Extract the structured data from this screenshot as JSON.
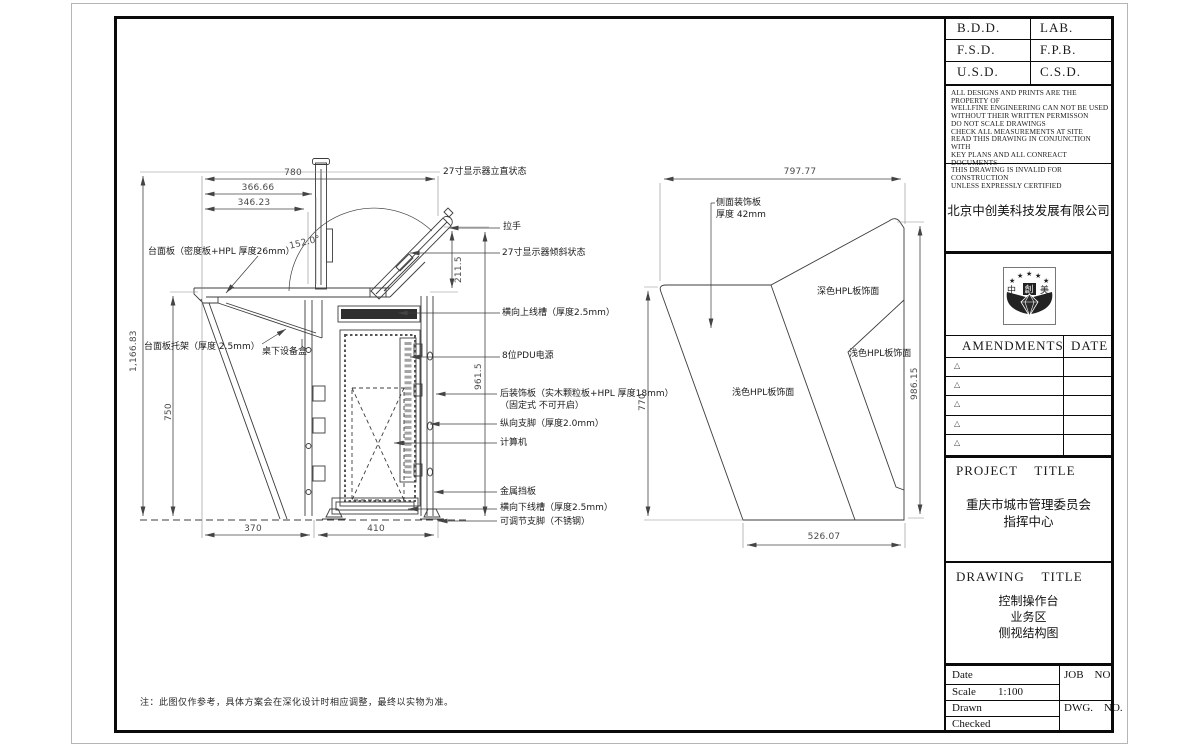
{
  "sheet": {
    "note": "注：此图仅作参考，具体方案会在深化设计时相应调整，最终以实物为准。"
  },
  "title_block": {
    "approval": [
      [
        "B.D.D.",
        "LAB."
      ],
      [
        "F.S.D.",
        "F.P.B."
      ],
      [
        "U.S.D.",
        "C.S.D."
      ]
    ],
    "disclaimer_lines": [
      "ALL DESIGNS AND PRINTS ARE THE PROPERTY OF",
      "WELLFINE ENGINEERING CAN NOT BE USED",
      "WITHOUT THEIR WRITTEN PERMISSON",
      "DO NOT SCALE DRAWINGS",
      "CHECK ALL MEASUREMENTS AT SITE",
      "READ THIS DRAWING IN CONJUNCTION WITH",
      "KEY PLANS AND ALL CONREACT DOCUMENTS",
      "THIS DRAWING IS INVALID FOR CONSTRUCTION",
      "UNLESS EXPRESSLY CERTIFIED"
    ],
    "company_name": "北京中创美科技发展有限公司",
    "logo": {
      "characters": "中創美",
      "star": "★"
    },
    "amendments": {
      "title": "AMENDMENTS",
      "date": "DATE",
      "marker": "△"
    },
    "project": {
      "label": "PROJECT    TITLE",
      "line1": "重庆市城市管理委员会",
      "line2": "指挥中心"
    },
    "drawing": {
      "label": "DRAWING    TITLE",
      "line1": "控制操作台",
      "line2": "业务区",
      "line3": "侧视结构图"
    },
    "info": {
      "date": "Date",
      "scale": "Scale",
      "scale_value": "1:100",
      "drawn": "Drawn",
      "checked": "Checked",
      "job_no": "JOB    NO.",
      "dwg_no": "DWG.    NO."
    }
  },
  "left_view": {
    "dims": {
      "overall_height": "1,166.83",
      "desk_height": "750",
      "top_width": "780",
      "width_366": "366.66",
      "width_346": "346.23",
      "tilt_angle": "152.0°",
      "monitor_offset": "211.5",
      "back_height": "961.5",
      "floor_front": "370",
      "floor_back": "410"
    },
    "labels": {
      "desk_panel": "台面板（密度板+HPL 厚度26mm）",
      "desk_bracket": "台面板托架（厚度 2.5mm）",
      "under_desk_box": "桌下设备盒",
      "monitor_upright": "27寸显示器立直状态",
      "handle": "拉手",
      "monitor_tilted": "27寸显示器倾斜状态",
      "upper_cable_trough": "横向上线槽（厚度2.5mm）",
      "pdu": "8位PDU电源",
      "back_panel_line1": "后装饰板（实木颗粒板+HPL 厚度18mm）",
      "back_panel_line2": "（固定式 不可开启）",
      "vertical_foot": "纵向支脚（厚度2.0mm）",
      "computer": "计算机",
      "metal_baffle": "金属挡板",
      "lower_cable_trough": "横向下线槽（厚度2.5mm）",
      "adjustable_foot": "可调节支脚（不锈钢）"
    }
  },
  "side_view": {
    "dims": {
      "top_width": "797.77",
      "right_height": "986.15",
      "left_height": "770",
      "bottom_width": "526.07"
    },
    "labels": {
      "side_panel_line1": "侧面装饰板",
      "side_panel_line2": "厚度 42mm",
      "dark_hpl": "深色HPL板饰面",
      "light_hpl_back": "浅色HPL板饰面",
      "light_hpl_front": "浅色HPL板饰面"
    }
  }
}
